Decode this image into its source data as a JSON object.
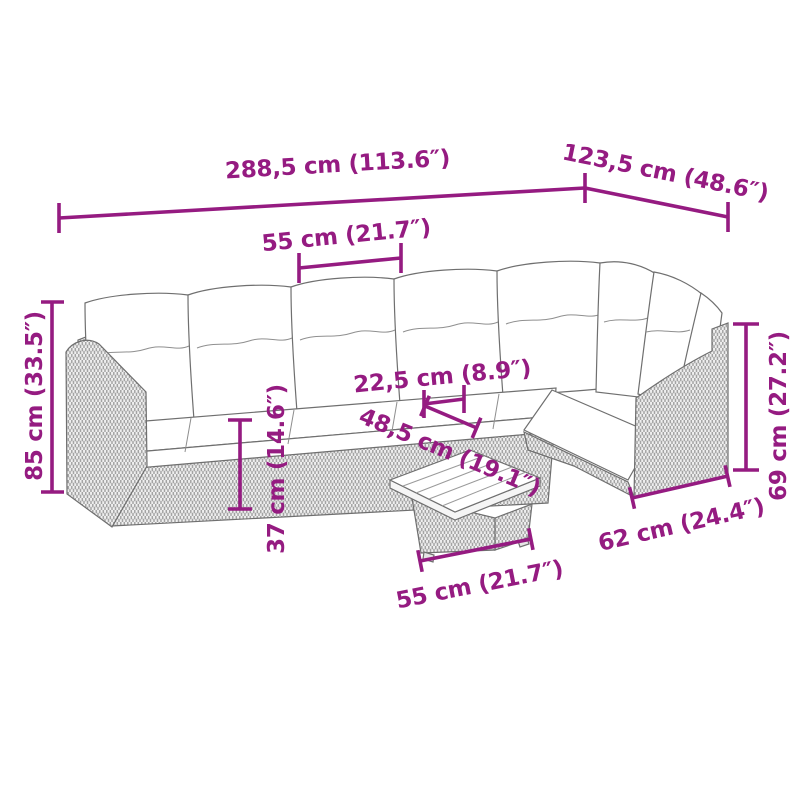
{
  "page": {
    "background": "#ffffff"
  },
  "diagram": {
    "kind": "furniture-dimension-diagram",
    "accent_color": "#951b81",
    "artwork_line_color": "#6f6f6f",
    "labels": {
      "overall_width": "288,5 cm (113.6″)",
      "overall_depth": "123,5 cm (48.6″)",
      "seat_width": "55 cm (21.7″)",
      "overall_height": "85 cm (33.5″)",
      "cushion_small": "22,5 cm (8.9″)",
      "diagonal": "48,5 cm (19.1″)",
      "seat_height": "37 cm (14.6″)",
      "armrest_height": "69 cm (27.2″)",
      "section_depth": "62 cm (24.4″)",
      "table_width": "55 cm (21.7″)"
    }
  }
}
